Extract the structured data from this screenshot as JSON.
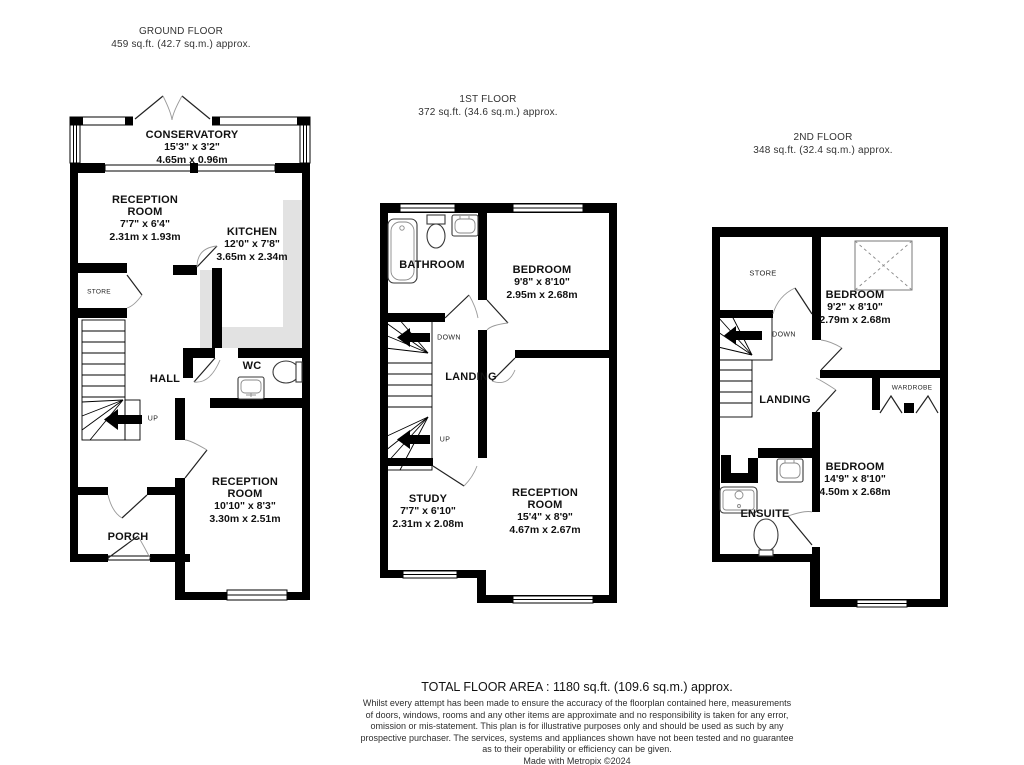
{
  "floors": [
    {
      "title": "GROUND FLOOR",
      "area": "459 sq.ft. (42.7 sq.m.) approx.",
      "rooms": {
        "conservatory": {
          "name": "CONSERVATORY",
          "imperial": "15'3\" x 3'2\"",
          "metric": "4.65m x 0.96m"
        },
        "reception1": {
          "name": "RECEPTION ROOM",
          "imperial": "7'7\" x 6'4\"",
          "metric": "2.31m x 1.93m"
        },
        "kitchen": {
          "name": "KITCHEN",
          "imperial": "12'0\" x 7'8\"",
          "metric": "3.65m x 2.34m"
        },
        "store": {
          "name": "STORE"
        },
        "hall": {
          "name": "HALL"
        },
        "wc": {
          "name": "WC"
        },
        "reception2": {
          "name": "RECEPTION ROOM",
          "imperial": "10'10\" x 8'3\"",
          "metric": "3.30m x 2.51m"
        },
        "porch": {
          "name": "PORCH"
        },
        "up": "UP"
      }
    },
    {
      "title": "1ST FLOOR",
      "area": "372 sq.ft. (34.6 sq.m.) approx.",
      "rooms": {
        "bathroom": {
          "name": "BATHROOM"
        },
        "bedroom": {
          "name": "BEDROOM",
          "imperial": "9'8\" x 8'10\"",
          "metric": "2.95m x 2.68m"
        },
        "landing": {
          "name": "LANDING"
        },
        "study": {
          "name": "STUDY",
          "imperial": "7'7\" x 6'10\"",
          "metric": "2.31m x 2.08m"
        },
        "reception": {
          "name": "RECEPTION ROOM",
          "imperial": "15'4\" x 8'9\"",
          "metric": "4.67m x 2.67m"
        },
        "down": "DOWN",
        "up": "UP"
      }
    },
    {
      "title": "2ND FLOOR",
      "area": "348 sq.ft. (32.4 sq.m.) approx.",
      "rooms": {
        "store": {
          "name": "STORE"
        },
        "bedroom1": {
          "name": "BEDROOM",
          "imperial": "9'2\" x 8'10\"",
          "metric": "2.79m x 2.68m"
        },
        "landing": {
          "name": "LANDING"
        },
        "wardrobe": {
          "name": "WARDROBE"
        },
        "bedroom2": {
          "name": "BEDROOM",
          "imperial": "14'9\" x 8'10\"",
          "metric": "4.50m x 2.68m"
        },
        "ensuite": {
          "name": "ENSUITE"
        },
        "down": "DOWN"
      }
    }
  ],
  "footer": {
    "total": "TOTAL FLOOR AREA : 1180 sq.ft. (109.6 sq.m.) approx.",
    "disclaimer_lines": [
      "Whilst every attempt has been made to ensure the accuracy of the floorplan contained here, measurements",
      "of doors, windows, rooms and any other items are approximate and no responsibility is taken for any error,",
      "omission or mis-statement. This plan is for illustrative purposes only and should be used as such by any",
      "prospective purchaser. The services, systems and appliances shown have not been tested and no guarantee",
      "as to their operability or efficiency can be given."
    ],
    "credit": "Made with Metropix ©2024"
  },
  "colors": {
    "wall": "#000000",
    "counter": "#e2e2e2",
    "door_arc": "#9a9a9a"
  }
}
